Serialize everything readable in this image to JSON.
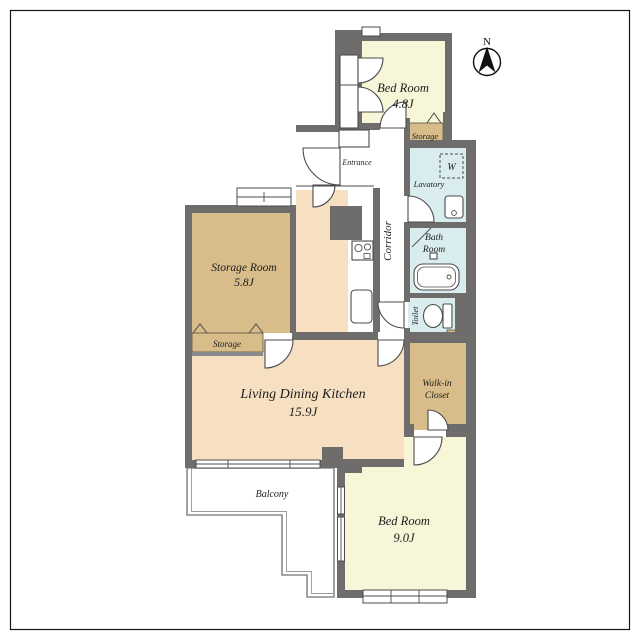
{
  "compass": {
    "label": "N"
  },
  "rooms": {
    "bedroom1": {
      "name": "Bed Room",
      "size": "4.8J"
    },
    "storage_top": {
      "name": "Storage"
    },
    "lavatory": {
      "name": "Lavatory"
    },
    "washer": {
      "label": "W"
    },
    "bathroom": {
      "name_line1": "Bath",
      "name_line2": "Room"
    },
    "toilet": {
      "name": "Toilet"
    },
    "corridor": {
      "name": "Corridor"
    },
    "entrance": {
      "name": "Entrance"
    },
    "storage_room": {
      "name": "Storage Room",
      "size": "5.8J"
    },
    "storage_left": {
      "name": "Storage"
    },
    "ldk": {
      "name": "Living Dining Kitchen",
      "size": "15.9J"
    },
    "walkin": {
      "name_line1": "Walk-in",
      "name_line2": "Closet"
    },
    "balcony": {
      "name": "Balcony"
    },
    "bedroom2": {
      "name": "Bed Room",
      "size": "9.0J"
    }
  },
  "colors": {
    "cream": "#f8f6d9",
    "peach": "#f7e0c1",
    "tan": "#d8bd8a",
    "blue": "#d9edef",
    "wall": "#6e6d6b",
    "white": "#ffffff",
    "frame": "#161616"
  }
}
